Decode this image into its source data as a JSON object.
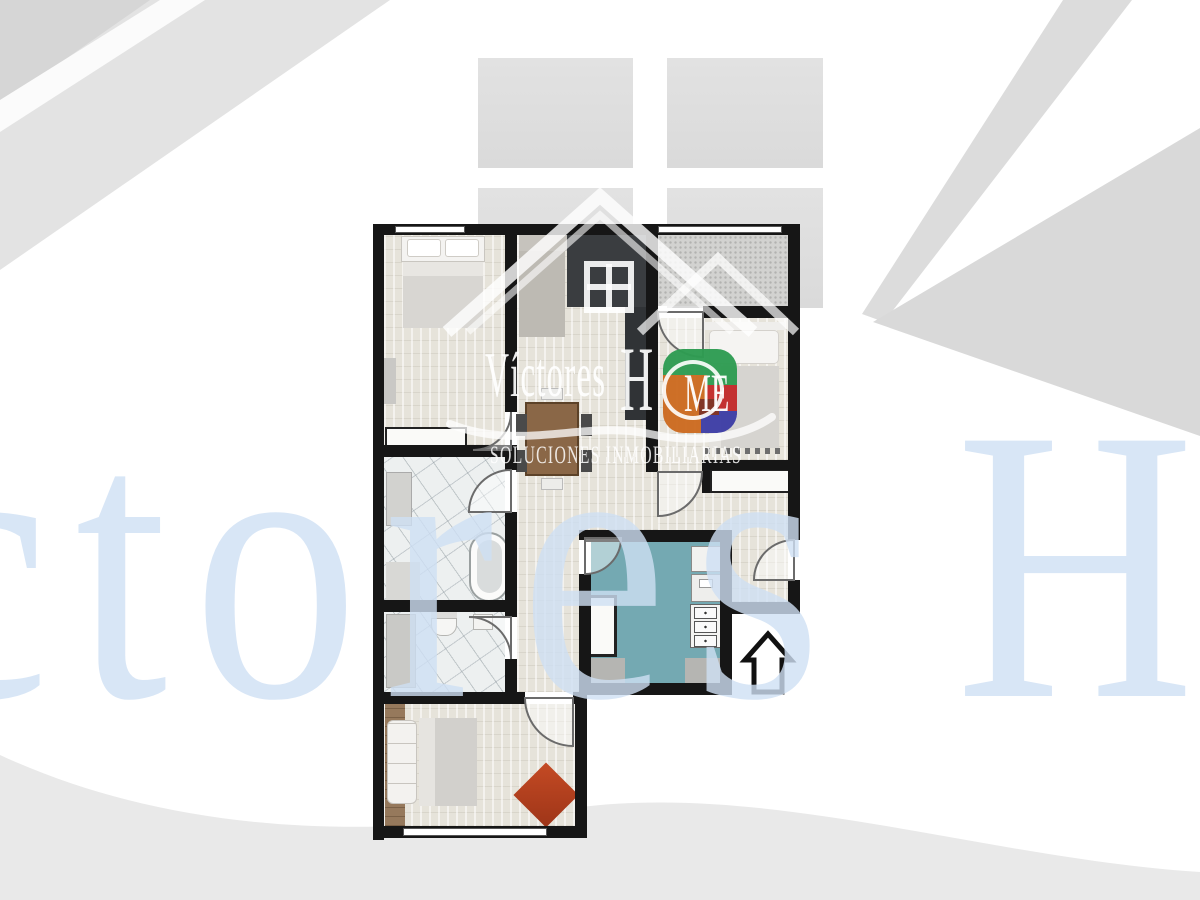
{
  "watermark": {
    "brand": "Víctores",
    "brand_h": "H",
    "brand_me": "ME",
    "subtitle": "SOLUCIONES INMOBILIARIAS",
    "giant_text": "íctores Ho"
  },
  "colors": {
    "wall": "#161616",
    "floor": "#e6e3da",
    "marble": "#edf0f0",
    "terrace": "#d2d2d0",
    "kitchen_teal": "#74a9b2",
    "rug_red": "#c14a24",
    "charcoal": "#3a3d40",
    "logo_green": "#2e9c52",
    "logo_orange": "#cd6b20",
    "logo_red": "#c32b2b",
    "logo_blue": "#3e3ea6",
    "giant_blue": "#cfe0f4",
    "shape_gray": "#dcdcdc",
    "swoosh_gray": "#e9e9e9"
  },
  "icons": {
    "north_arrow": "up"
  }
}
